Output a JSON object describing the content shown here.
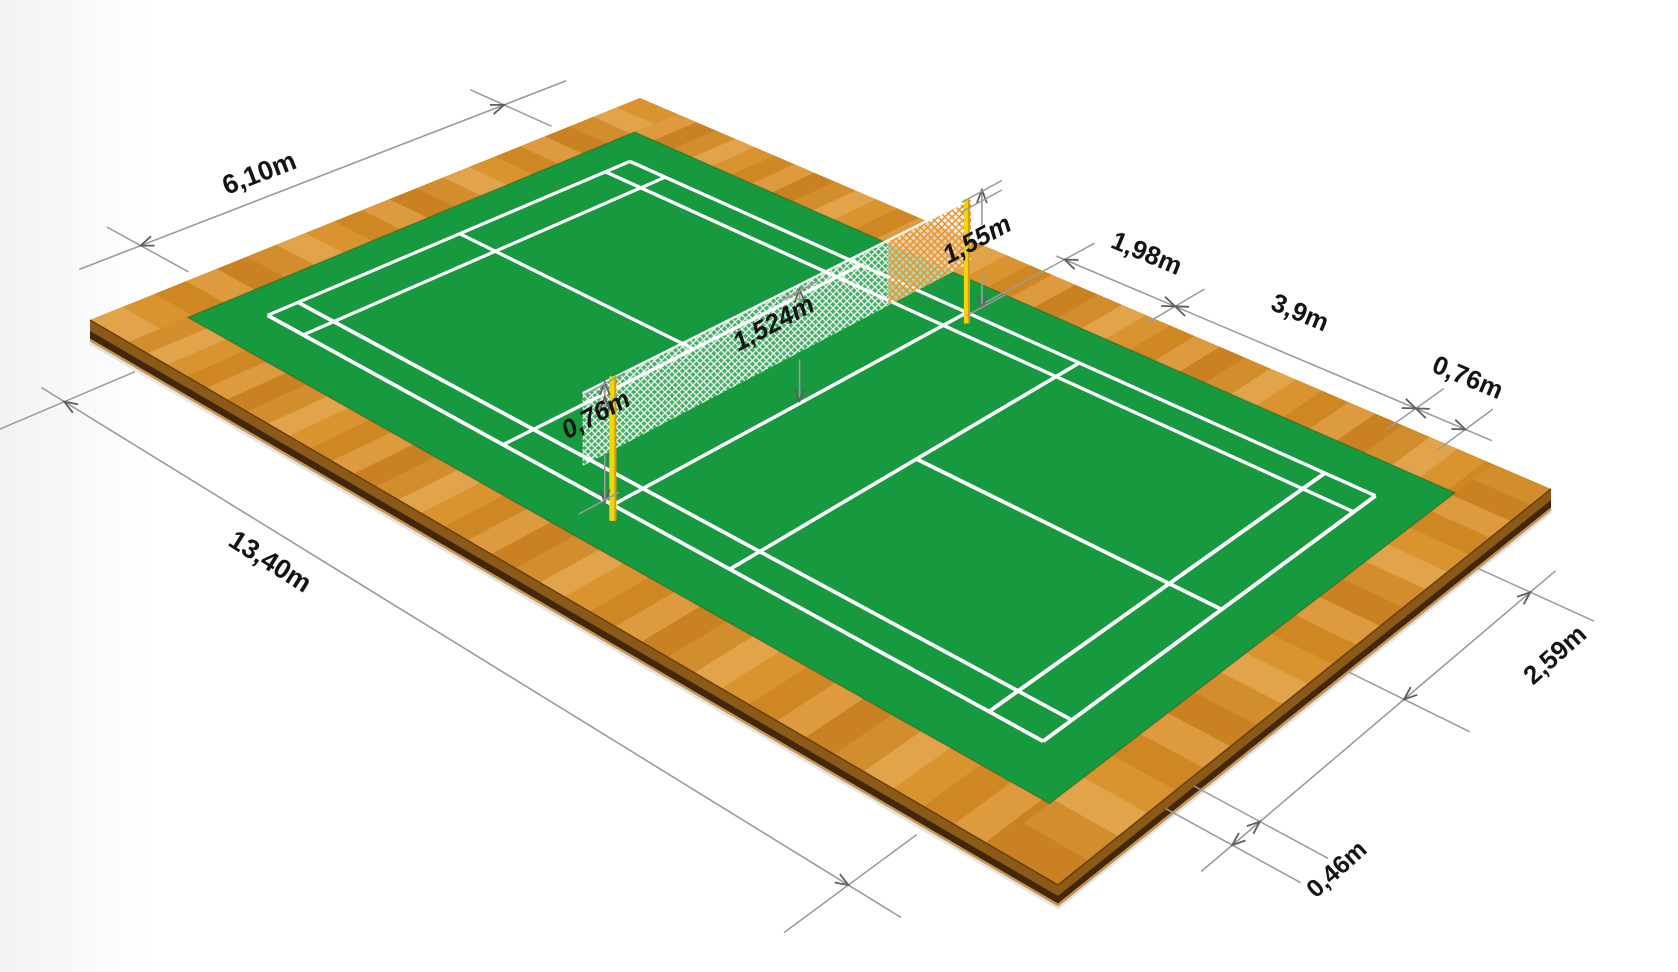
{
  "page": {
    "background": "#ffffff",
    "left_fade": "#f1f2f4"
  },
  "diagram": {
    "subject": "Badminton court dimensions (isometric view)",
    "colors": {
      "court_green": "#16993f",
      "line_white": "#ffffff",
      "wood_light": "#e2a44b",
      "wood_mid": "#d28d2c",
      "wood_dark_side": "#8a5a16",
      "wood_deep_side": "#43270a",
      "wood_bottom_edge": "#c89552",
      "wood_edge_line": "#6b3f0c",
      "post_yellow": "#f5d409",
      "post_shade": "#cf9f05",
      "net_orange": "#e8922a",
      "dim_line_gray": "#9b9b9b",
      "arrow_gray": "#5f5f5f",
      "label_color": "#141414"
    },
    "dims": {
      "width_total": {
        "text": "6,10m",
        "meters": 6.1
      },
      "length_total": {
        "text": "13,40m",
        "meters": 13.4
      },
      "post_height": {
        "text": "1,55m",
        "meters": 1.55
      },
      "net_to_short_service": {
        "text": "1,98m",
        "meters": 1.98
      },
      "short_to_long_service": {
        "text": "3,9m",
        "meters": 3.9
      },
      "long_service_to_back": {
        "text": "0,76m",
        "meters": 0.76
      },
      "net_bottom_height": {
        "text": "0,76m",
        "meters": 0.76
      },
      "net_center_height": {
        "text": "1,524m",
        "meters": 1.524
      },
      "center_to_singles_sideline": {
        "text": "2,59m",
        "meters": 2.59
      },
      "singles_to_doubles_sideline": {
        "text": "0,46m",
        "meters": 0.46
      }
    }
  }
}
